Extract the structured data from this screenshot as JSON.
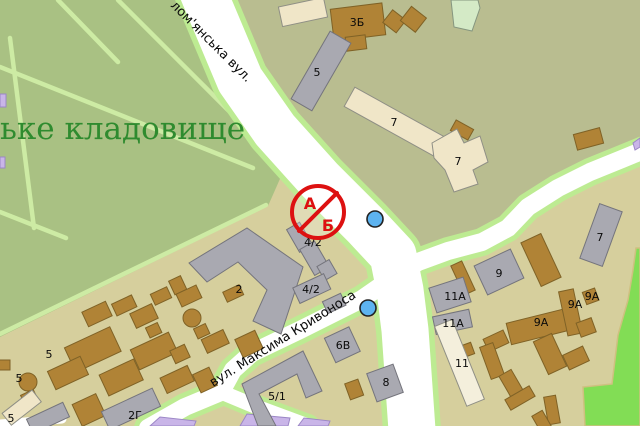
{
  "map": {
    "cemetery_label": "ьке кладовище",
    "street_labels": {
      "solomianska": "лом'янська вул.",
      "kryvonosa": "вул. Максима Кривоноса"
    },
    "prohibition_sign": {
      "letter_top": "А",
      "letter_bottom": "Б"
    },
    "building_labels": {
      "b3b": "3Б",
      "b5top": "5",
      "b7long": "7",
      "b7l": "7",
      "b7gray": "7",
      "b2": "2",
      "b42a": "4/2",
      "b42b": "4/2",
      "b5a": "5",
      "b5b": "5",
      "b5c": "5",
      "b2g": "2Г",
      "b51": "5/1",
      "b6v": "6В",
      "b8": "8",
      "b9": "9",
      "b11a1": "11А",
      "b11a2": "11А",
      "b9a1": "9А",
      "b9a2": "9А",
      "b9a3": "9А",
      "b11": "11"
    },
    "markers": {
      "type": "point-marker"
    }
  },
  "palette": {
    "block_tan": "#d6cf9d",
    "block_olive": "#b9bd90",
    "cemetery_green": "#a9c183",
    "cemetery_path": "#cdeba4",
    "park_green": "#82dd55",
    "road_core": "#ffffff",
    "road_casing": "#bdeb92",
    "building_brown": "#b08336",
    "building_gray": "#a9a9b1",
    "building_cream": "#f0e6c8",
    "building_lavender": "#c9b5e8",
    "sign_red": "#dd1111",
    "marker_blue": "#5db3f0",
    "label_text": "#0a0a0a",
    "cemetery_text": "#2f8b2f"
  }
}
